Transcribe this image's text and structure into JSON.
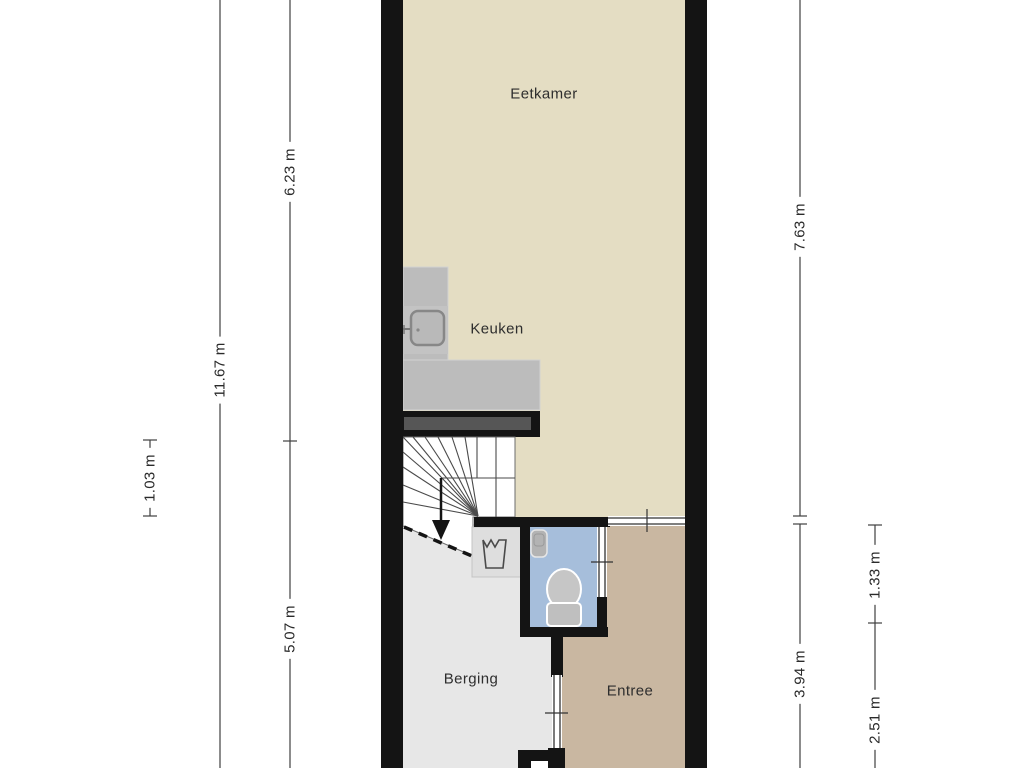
{
  "floorplan": {
    "rooms": {
      "eetkamer": {
        "label": "Eetkamer"
      },
      "keuken": {
        "label": "Keuken"
      },
      "berging": {
        "label": "Berging"
      },
      "entree": {
        "label": "Entree"
      }
    },
    "dimensions": {
      "left": [
        {
          "id": "total-depth",
          "label": "11.67 m"
        },
        {
          "id": "eetkamer-depth",
          "label": "6.23 m"
        },
        {
          "id": "stair-landing",
          "label": "1.03 m"
        },
        {
          "id": "berging-depth",
          "label": "5.07 m"
        }
      ],
      "right": [
        {
          "id": "upper-depth",
          "label": "7.63 m"
        },
        {
          "id": "entree-depth",
          "label": "3.94 m"
        },
        {
          "id": "toilet-depth",
          "label": "1.33 m"
        },
        {
          "id": "hall-depth",
          "label": "2.51 m"
        }
      ]
    },
    "colors": {
      "wall": "#141414",
      "eetkamer_floor": "#e4ddc3",
      "entree_floor": "#c9b7a1",
      "toilet_floor": "#a6bedb",
      "berging_floor": "#e7e7e7",
      "counter": "#bcbcbc",
      "stairs": "#ffffff"
    },
    "icons": [
      "kitchen-sink",
      "laundry-tub",
      "toilet",
      "hand-basin",
      "stairs-down-arrow"
    ]
  }
}
